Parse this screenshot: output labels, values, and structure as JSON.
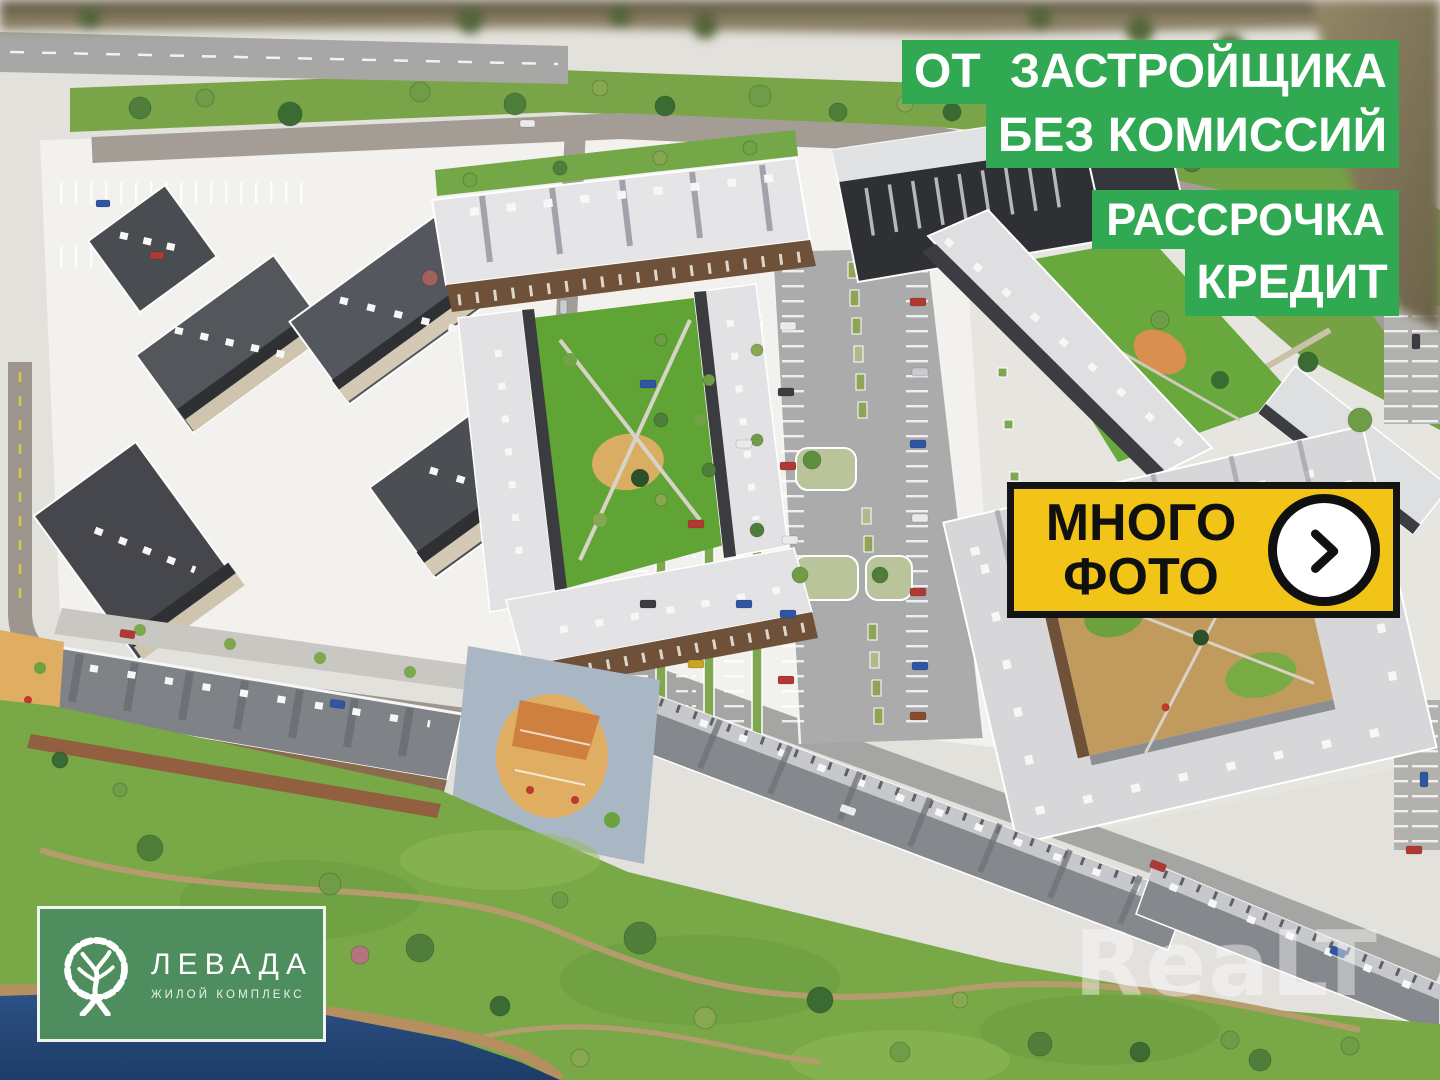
{
  "page": {
    "kind": "real-estate-listing-photo",
    "subject": "aerial photo of a residential complex architectural scale model"
  },
  "promo_banners": {
    "bg_color": "#31a852",
    "text_color": "#ffffff",
    "lines": [
      {
        "label": "ОТ ЗАСТРОЙЩИКА"
      },
      {
        "label": "БЕЗ КОМИССИЙ"
      },
      {
        "label": "РАССРОЧКА"
      },
      {
        "label": "КРЕДИТ"
      }
    ]
  },
  "photo_button": {
    "label_line1": "МНОГО",
    "label_line2": "ФОТО",
    "bg_color": "#f2c417",
    "border_color": "#141414",
    "icon": "chevron-right-circle-icon"
  },
  "logo_card": {
    "name": "ЛЕВАДА",
    "subtitle": "ЖИЛОЙ КОМПЛЕКС",
    "bg_color": "#4e8d5e",
    "icon": "tree-road-icon"
  },
  "watermark": {
    "text": "ReaLT"
  },
  "scene": {
    "water_color": "#24467a",
    "lawn_color": "#79a847",
    "model_ground_color": "#f2f1ed",
    "road_color": "#a9a9a9"
  }
}
